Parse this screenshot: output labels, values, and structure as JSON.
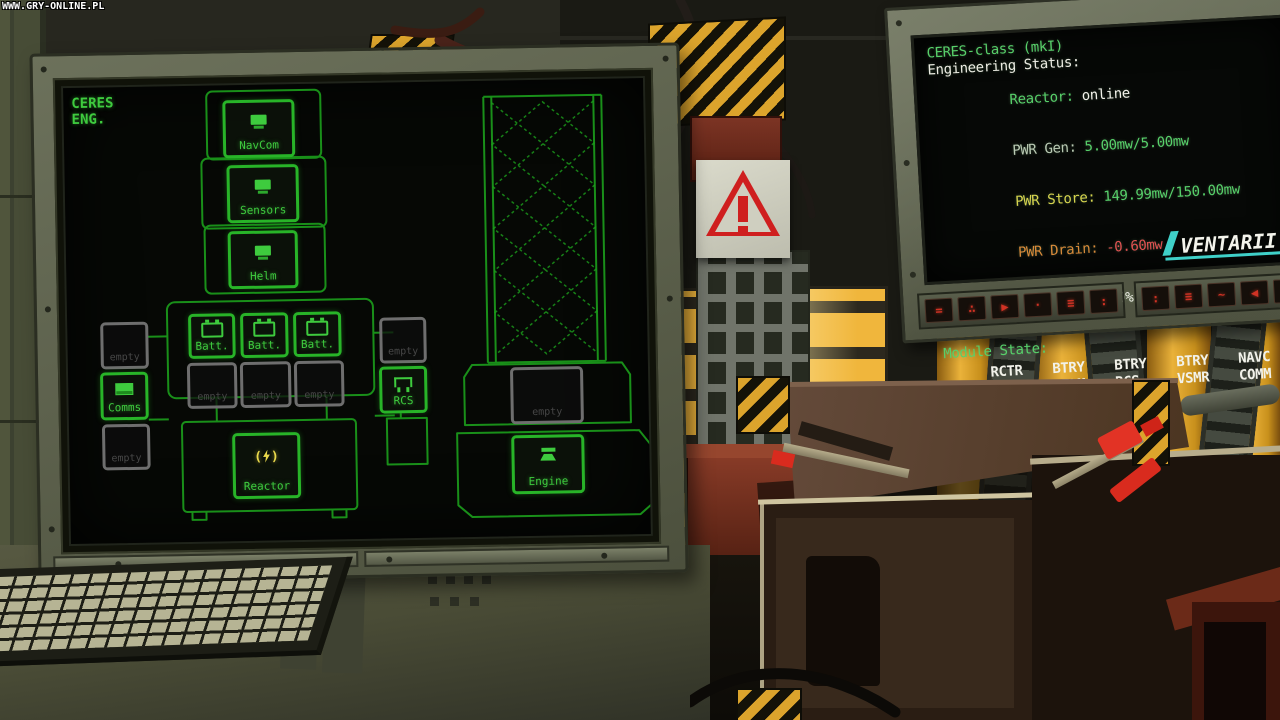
{
  "watermark": "WWW.GRY-ONLINE.PL",
  "left_monitor": {
    "header": [
      "CERES",
      "ENG."
    ],
    "modules": {
      "navcom": {
        "label": "NavCom"
      },
      "sensors": {
        "label": "Sensors"
      },
      "helm": {
        "label": "Helm"
      },
      "batt1": {
        "label": "Batt."
      },
      "batt2": {
        "label": "Batt."
      },
      "batt3": {
        "label": "Batt."
      },
      "comms": {
        "label": "Comms"
      },
      "rcs": {
        "label": "RCS"
      },
      "reactor": {
        "label": "Reactor"
      },
      "engine": {
        "label": "Engine"
      },
      "empty": {
        "label": "empty"
      }
    }
  },
  "right_monitor": {
    "title": "CERES-class (mkI)",
    "subtitle": "Engineering Status:",
    "rows": [
      {
        "name": "reactor",
        "label": "Reactor:",
        "value": "online"
      },
      {
        "name": "pwr_gen",
        "label": "PWR Gen:",
        "value": "5.00mw/5.00mw"
      },
      {
        "name": "pwr_store",
        "label": "PWR Store:",
        "value": "149.99mw/150.00mw"
      },
      {
        "name": "pwr_drain",
        "label": "PWR Drain:",
        "value": "-0.60mw"
      },
      {
        "name": "efficiency",
        "label": "Efficiency:",
        "value": "100%"
      }
    ],
    "module_state_title": "Module State:",
    "module_grid": [
      "RCTR",
      "BTRY",
      "BTRY",
      "BTRY",
      "NAVC",
      "SENS",
      "HELM",
      "RCS",
      "VSMR",
      "COMM",
      "WEAP"
    ],
    "brand": "VENTARII",
    "buttons": [
      "=",
      "∴",
      "▶",
      "·",
      "≡",
      ":",
      ":",
      "≡",
      "~",
      "◀",
      "∴",
      "∷"
    ]
  },
  "palette": {
    "screen_green": "#3ecb3e",
    "hull_green": "#1c9e1c",
    "status_green": "#57d06a",
    "status_yellow": "#d6d44e",
    "status_orange": "#d98a3a",
    "status_red": "#e05252",
    "status_teal": "#56c4c4",
    "brand_teal": "#3fd0c8",
    "hazard_yellow": "#dca42c",
    "warning_red": "#cf1f1f",
    "coil_yellow": "#eab23a",
    "reactor_icon_yellow": "#ead94b"
  }
}
